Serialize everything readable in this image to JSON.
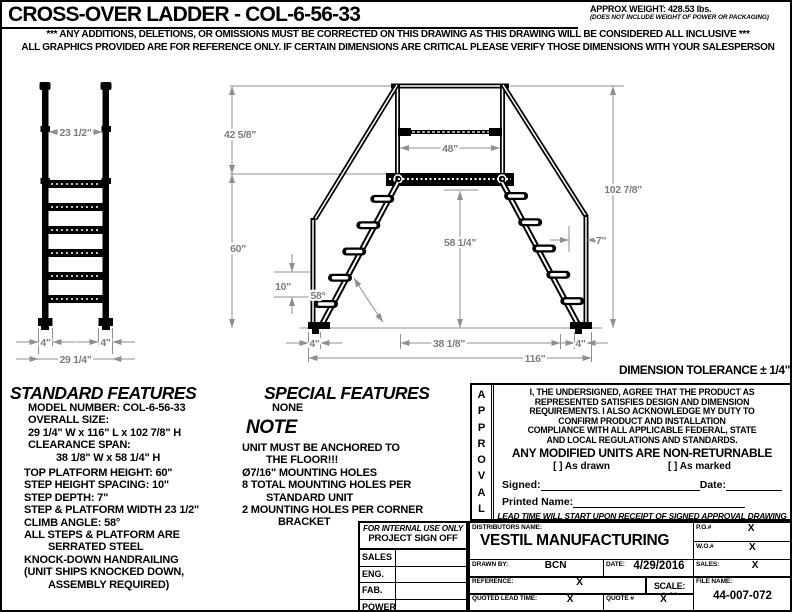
{
  "header": {
    "title": "CROSS-OVER LADDER - COL-6-56-33",
    "approx_weight": "APPROX WEIGHT: 428.53 lbs.",
    "weight_note": "(DOES NOT INCLUDE WEIGHT OF POWER OR PACKAGING)",
    "disclaimer1": "*** ANY ADDITIONS, DELETIONS, OR OMISSIONS MUST BE CORRECTED ON THIS DRAWING AS THIS DRAWING WILL BE CONSIDERED ALL INCLUSIVE ***",
    "disclaimer2": "ALL GRAPHICS PROVIDED ARE FOR REFERENCE ONLY. IF CERTAIN DIMENSIONS ARE CRITICAL PLEASE VERIFY THOSE DIMENSIONS WITH YOUR SALESPERSON"
  },
  "drawing": {
    "front_view": {
      "rail_span": "23 1/2\"",
      "left_foot": "4\"",
      "right_foot": "4\"",
      "overall_width": "29 1/4\""
    },
    "side_view": {
      "handrail_rise": "42 5/8\"",
      "platform_length": "48\"",
      "overall_height": "102 7/8\"",
      "platform_height": "60\"",
      "step_spacing": "10\"",
      "climb_angle": "58°",
      "clearance_height": "58 1/4\"",
      "step_depth": "7\"",
      "left_foot": "4\"",
      "clearance_span": "38 1/8\"",
      "right_foot": "4\"",
      "overall_length": "116\""
    },
    "tolerance_note": "DIMENSION TOLERANCE ± 1/4\""
  },
  "standard_features": {
    "title": "STANDARD FEATURES",
    "lines": [
      "MODEL NUMBER: COL-6-56-33",
      "OVERALL SIZE:",
      "29 1/4\" W x 116\" L x 102 7/8\" H",
      "CLEARANCE SPAN:",
      "38 1/8\" W x 58 1/4\" H",
      "TOP PLATFORM HEIGHT: 60\"",
      "STEP HEIGHT SPACING: 10\"",
      "STEP DEPTH: 7\"",
      "STEP & PLATFORM WIDTH 23 1/2\"",
      "CLIMB ANGLE: 58°",
      "ALL STEPS & PLATFORM ARE",
      "SERRATED STEEL",
      "KNOCK-DOWN HANDRAILING",
      "(UNIT SHIPS KNOCKED DOWN,",
      "ASSEMBLY REQUIRED)"
    ]
  },
  "special_features": {
    "title": "SPECIAL FEATURES",
    "value": "NONE"
  },
  "note": {
    "title": "NOTE",
    "lines": [
      "UNIT MUST BE ANCHORED TO",
      "THE FLOOR!!!",
      "Ø7/16\" MOUNTING HOLES",
      "8 TOTAL MOUNTING HOLES PER",
      "STANDARD UNIT",
      "2 MOUNTING HOLES PER CORNER",
      "BRACKET"
    ]
  },
  "approval": {
    "side_letters": [
      "A",
      "P",
      "P",
      "R",
      "O",
      "V",
      "A",
      "L"
    ],
    "agreement": "I, THE UNDERSIGNED, AGREE THAT THE PRODUCT AS\nREPRESENTED SATISFIES DESIGN AND DIMENSION\nREQUIREMENTS. I ALSO ACKNOWLEDGE MY DUTY TO\nCONFIRM PRODUCT AND INSTALLATION\nCOMPLIANCE WITH ALL APPLICABLE FEDERAL, STATE\nAND LOCAL REGULATIONS AND STANDARDS.",
    "warning": "ANY MODIFIED UNITS ARE NON-RETURNABLE",
    "checkbox_drawn": "[  ] As drawn",
    "checkbox_marked": "[  ] As marked",
    "signed_label": "Signed:",
    "date_label": "Date:",
    "printed_name_label": "Printed Name:",
    "lead_time_note": "LEAD TIME WILL START UPON RECEIPT OF SIGNED APPROVAL DRAWING"
  },
  "sign_off": {
    "header_line1": "FOR INTERNAL USE ONLY",
    "header_line2": "PROJECT SIGN OFF",
    "rows": [
      "SALES",
      "ENG.",
      "FAB.",
      "POWER"
    ]
  },
  "title_block": {
    "distributors_label": "DISTRIBUTORS NAME:",
    "company": "VESTIL MANUFACTURING",
    "po_label": "P.O.#",
    "po_value": "X",
    "wo_label": "W.O.#",
    "wo_value": "X",
    "drawn_by_label": "DRAWN BY:",
    "drawn_by_value": "BCN",
    "date_label": "DATE:",
    "date_value": "4/29/2016",
    "sales_label": "SALES:",
    "sales_value": "X",
    "reference_label": "REFERENCE:",
    "reference_value": "X",
    "scale_label": "SCALE: 1:30",
    "file_name_label": "FILE NAME:",
    "file_name_value": "44-007-072",
    "quoted_lead_label": "QUOTED LEAD TIME:",
    "quoted_lead_value": "X",
    "quote_label": "QUOTE #",
    "quote_value": "X"
  }
}
